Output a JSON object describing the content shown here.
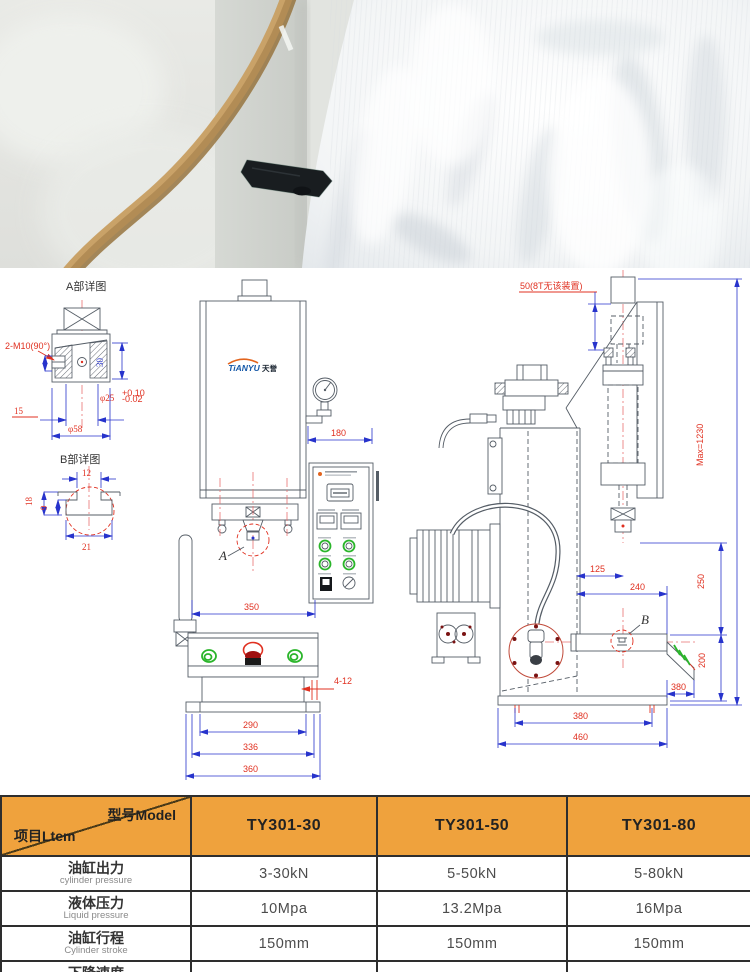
{
  "colors": {
    "table_header_orange": "#efa23d",
    "dimension_blue": "#2733cc",
    "annotation_red": "#e03020",
    "line_gray": "#555d66"
  },
  "drawing": {
    "detail_a": {
      "title": "A部详图",
      "thread": "2-M10(90°)",
      "dim_30": "30",
      "dim_15": "15",
      "bore": "φ25",
      "tol_plus": "+0.10",
      "tol_minus": "-0.02",
      "outer_dia": "φ58",
      "callout": "A"
    },
    "detail_b": {
      "title": "B部详图",
      "dim_12": "12",
      "dim_18": "18",
      "dim_9": "9",
      "dim_21": "21",
      "callout": "B"
    },
    "front_view": {
      "logo_en": "TiANYU",
      "logo_cn": "天誉",
      "dim_180": "180",
      "dim_350": "350",
      "dim_holes": "4-12",
      "dim_290": "290",
      "dim_336": "336",
      "dim_360": "360"
    },
    "side_view": {
      "note_50": "50(8T无该装置)",
      "max_height": "Max=1230",
      "dim_125": "125",
      "dim_240": "240",
      "dim_250": "250",
      "dim_200": "200",
      "dim_380_right": "380",
      "dim_380_bottom": "380",
      "dim_460": "460"
    }
  },
  "spec_table": {
    "header": {
      "model_label": "型号Model",
      "item_label": "项目Ltem",
      "models": [
        "TY301-30",
        "TY301-50",
        "TY301-80"
      ]
    },
    "rows": [
      {
        "cn": "油缸出力",
        "en": "cylinder pressure",
        "values": [
          "3-30kN",
          "5-50kN",
          "5-80kN"
        ]
      },
      {
        "cn": "液体压力",
        "en": "Liquid pressure",
        "values": [
          "10Mpa",
          "13.2Mpa",
          "16Mpa"
        ]
      },
      {
        "cn": "油缸行程",
        "en": "Cylinder stroke",
        "values": [
          "150mm",
          "150mm",
          "150mm"
        ]
      },
      {
        "cn": "下降速度",
        "en": "",
        "values": [
          "",
          "",
          ""
        ]
      }
    ]
  }
}
